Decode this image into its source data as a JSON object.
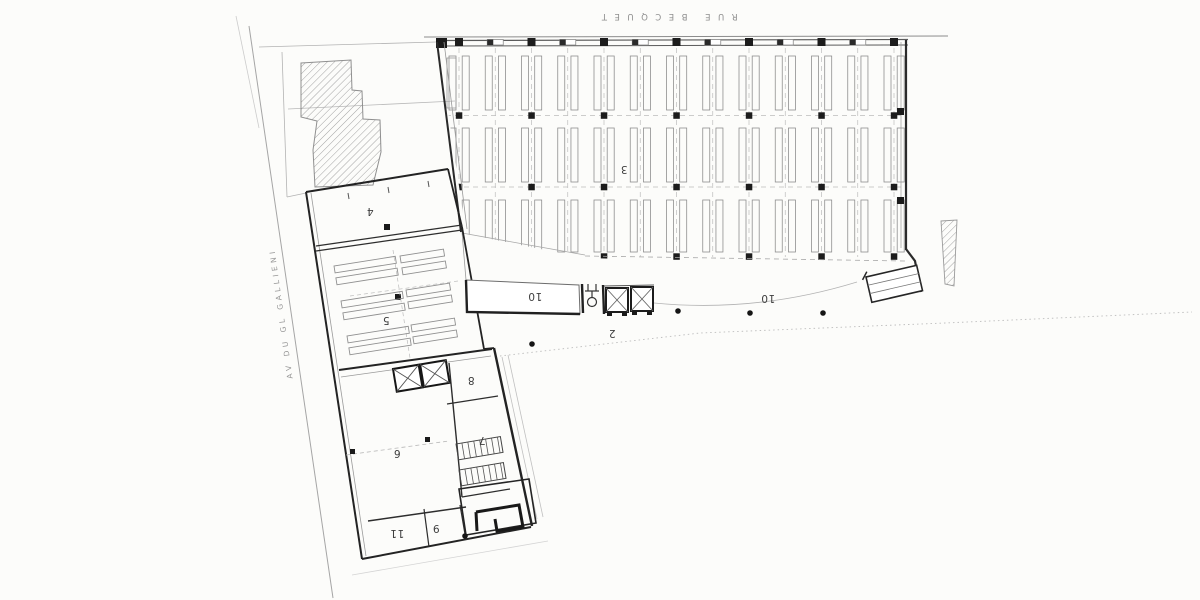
{
  "streets": {
    "top": "RUE BECQUET",
    "left": "AV DU GL GALLIENI"
  },
  "rooms": {
    "r2": "2",
    "r3": "3",
    "r4": "4",
    "r5": "5",
    "r6": "6",
    "r7": "7",
    "r8": "8",
    "r9": "9",
    "r10_dock": "10",
    "r10_yard": "10",
    "r11": "11"
  },
  "colors": {
    "paper": "#fcfcfa",
    "wall_ink": "#232323",
    "line_thin": "#8f8f8f",
    "line_faint": "#b5b5b5",
    "hatch": "#a3a3a3",
    "label_ink": "#3e3e3e",
    "street_ink": "#8f8f8f"
  }
}
